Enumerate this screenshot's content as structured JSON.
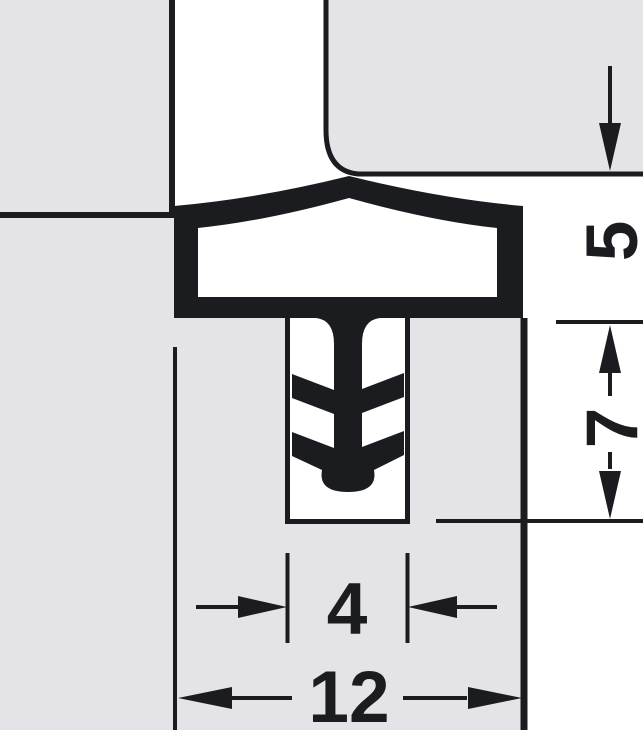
{
  "diagram": {
    "type": "technical-cross-section",
    "subject": "door-seal-profile-in-groove",
    "colors": {
      "material_fill": "#e4e4e8",
      "line": "#1b1c20",
      "background": "#ffffff"
    },
    "dimensions": [
      {
        "id": "seal-head-height",
        "value": "5",
        "orientation": "vertical"
      },
      {
        "id": "groove-depth",
        "value": "7",
        "orientation": "vertical"
      },
      {
        "id": "groove-width",
        "value": "4",
        "orientation": "horizontal"
      },
      {
        "id": "rebate-width",
        "value": "12",
        "orientation": "horizontal"
      }
    ]
  }
}
